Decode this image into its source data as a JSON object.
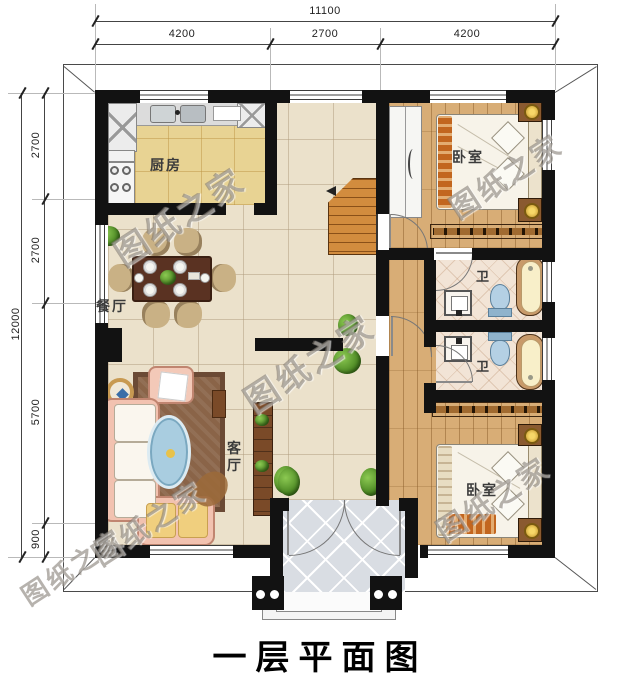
{
  "title": "一层平面图",
  "watermark": {
    "text": "图纸之家"
  },
  "dimensions": {
    "top": {
      "total": "11100",
      "segments": [
        "4200",
        "2700",
        "4200"
      ]
    },
    "left": {
      "total": "12000",
      "segments": [
        "2700",
        "2700",
        "5700",
        "900"
      ]
    }
  },
  "rooms": {
    "kitchen": {
      "label": "厨房"
    },
    "dining": {
      "label": "餐厅"
    },
    "living": {
      "label": "客厅"
    },
    "bedroom_top": {
      "label": "卧室"
    },
    "bedroom_bottom": {
      "label": "卧室"
    },
    "bath_top": {
      "label": "卫"
    },
    "bath_bottom": {
      "label": "卫"
    }
  },
  "palette": {
    "wall": "#121212",
    "tile_floor": "#ebe1cb",
    "kitchen_floor": "#e8d393",
    "wood_floor": "#d8ad76",
    "bath_floor": "#f2e4d6",
    "porch_floor": "#d9dde3",
    "stairs": "#d28c3e",
    "rug": "#8a6448",
    "sofa": "#f2c2b0",
    "dining_table": "#5a3222",
    "bathtub": "#f8efc9",
    "toilet": "#b4d0e4",
    "plant": "#46821f",
    "watermark_gray": "#7a736a"
  }
}
